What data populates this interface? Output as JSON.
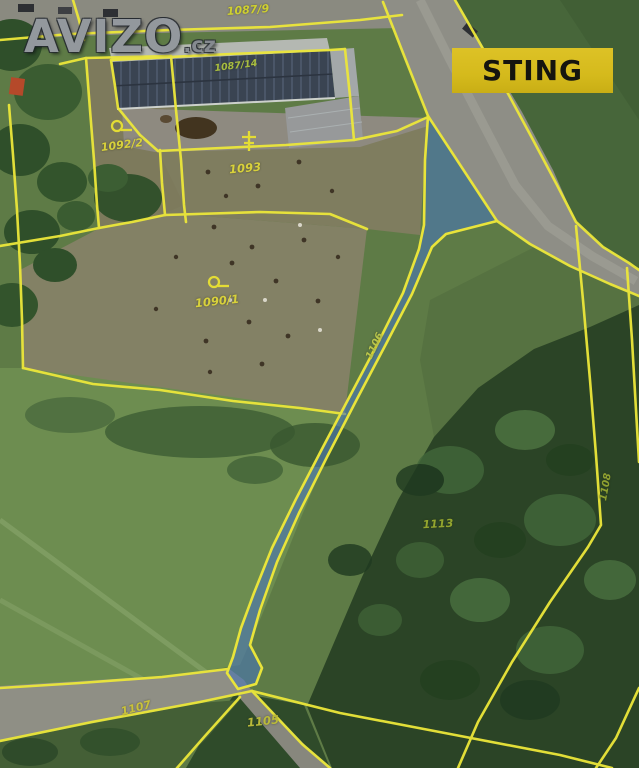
{
  "watermark": {
    "brand": "AVIZO",
    "tld": ".cz"
  },
  "badge": {
    "label": "STING"
  },
  "map": {
    "type": "cadastral-aerial-map",
    "highlight_fill": "#4a76b5",
    "boundary_color": "#ece73a",
    "labels": [
      {
        "text": "1087/9"
      },
      {
        "text": "1087/14"
      },
      {
        "text": "1092/2"
      },
      {
        "text": "1093"
      },
      {
        "text": "1090/1"
      },
      {
        "text": "1106"
      },
      {
        "text": "1113"
      },
      {
        "text": "1108"
      },
      {
        "text": "1107"
      },
      {
        "text": "1105"
      }
    ],
    "symbols": [
      "pasture-symbol",
      "pasture-symbol",
      "tree-symbol"
    ]
  }
}
